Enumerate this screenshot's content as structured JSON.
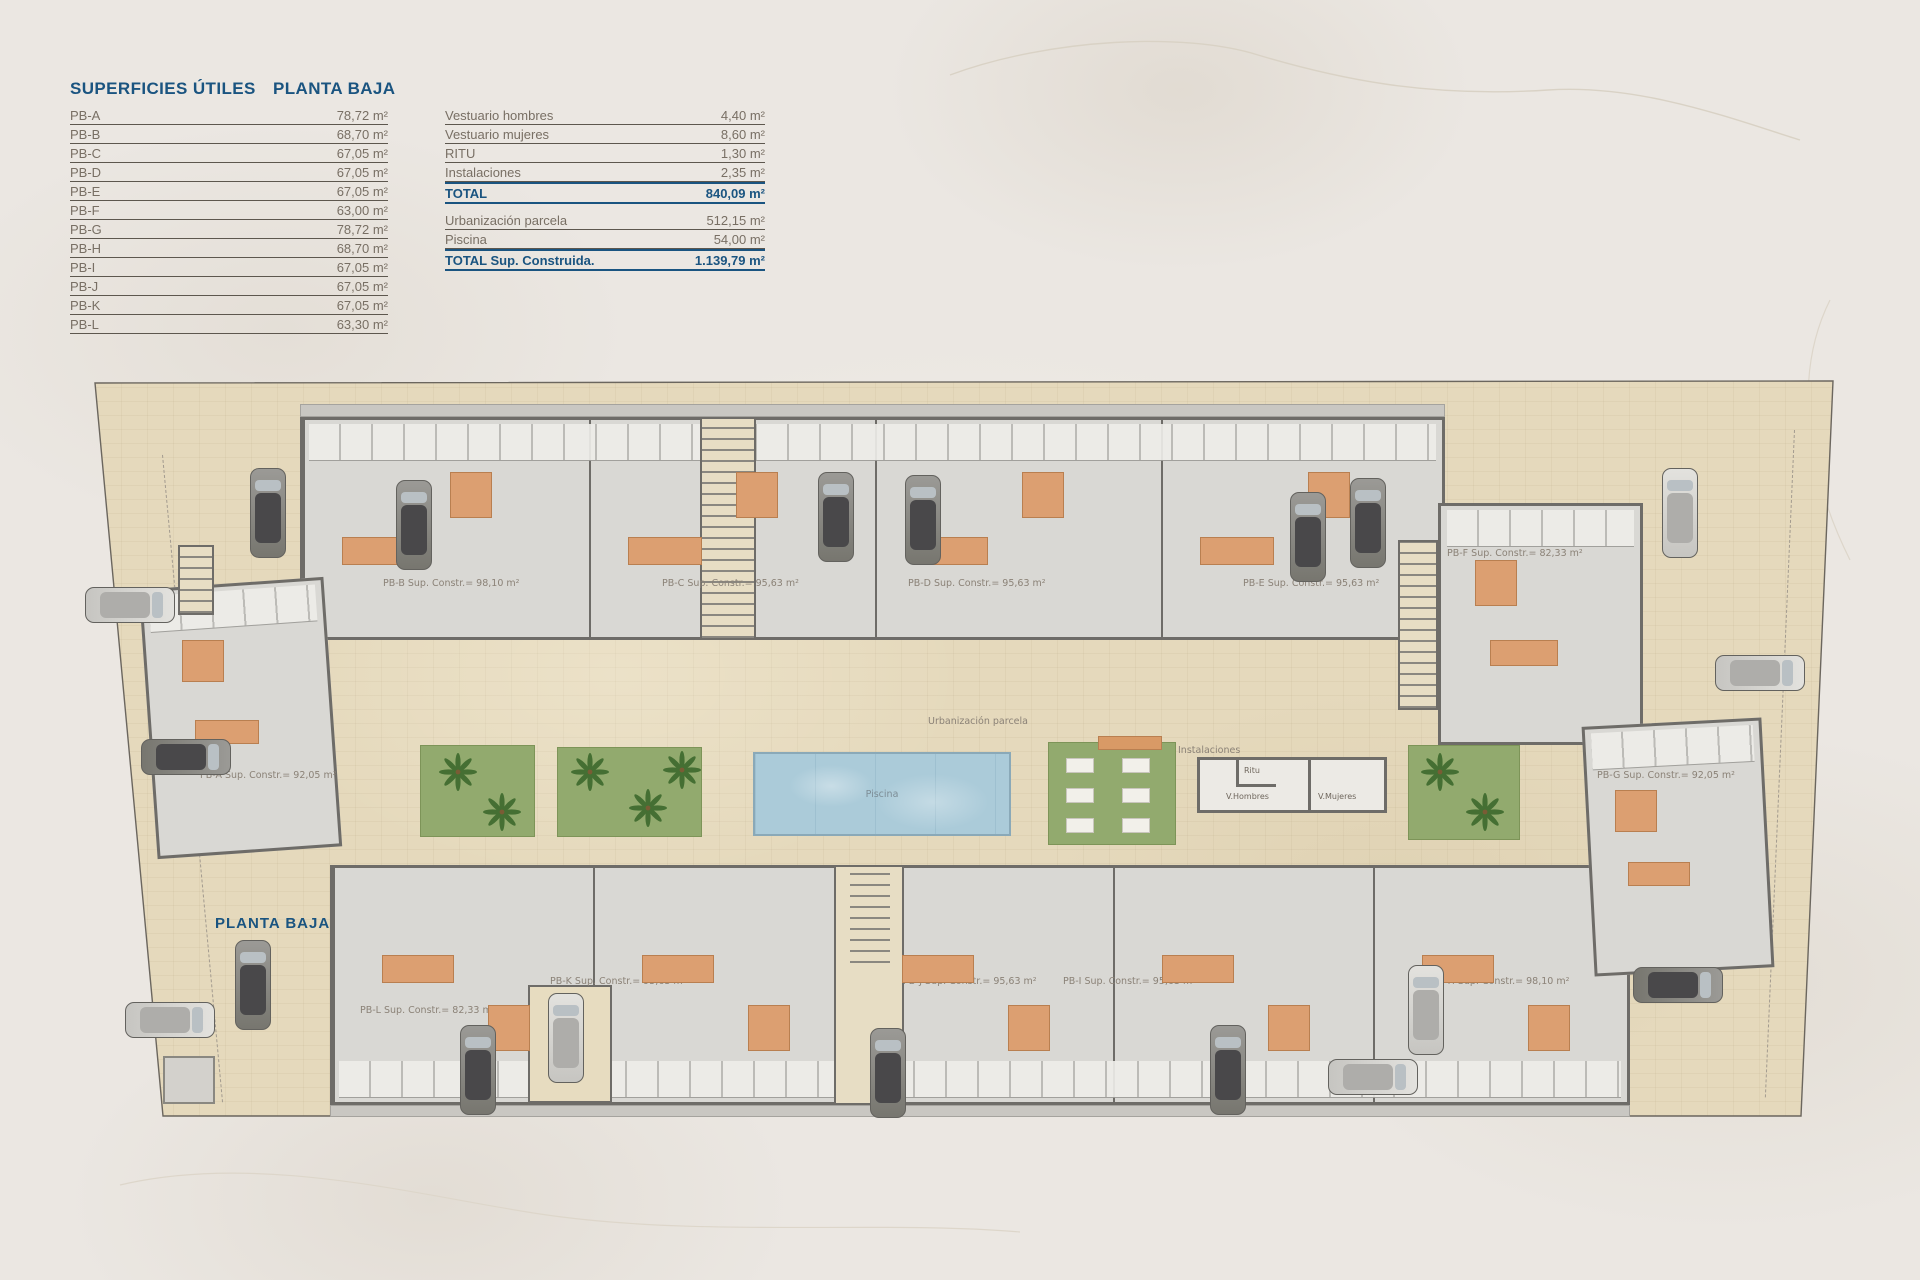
{
  "header": {
    "surfaces_title": "SUPERFICIES ÚTILES",
    "floor_title": "PLANTA BAJA"
  },
  "footer": {
    "floor_title": "PLANTA BAJA"
  },
  "surfaces_table": {
    "rows": [
      {
        "label": "PB-A",
        "value": "78,72 m²"
      },
      {
        "label": "PB-B",
        "value": "68,70 m²"
      },
      {
        "label": "PB-C",
        "value": "67,05 m²"
      },
      {
        "label": "PB-D",
        "value": "67,05 m²"
      },
      {
        "label": "PB-E",
        "value": "67,05 m²"
      },
      {
        "label": "PB-F",
        "value": "63,00 m²"
      },
      {
        "label": "PB-G",
        "value": "78,72 m²"
      },
      {
        "label": "PB-H",
        "value": "68,70 m²"
      },
      {
        "label": "PB-I",
        "value": "67,05 m²"
      },
      {
        "label": "PB-J",
        "value": "67,05 m²"
      },
      {
        "label": "PB-K",
        "value": "67,05 m²"
      },
      {
        "label": "PB-L",
        "value": "63,30 m²"
      }
    ]
  },
  "common_table": {
    "rows": [
      {
        "label": "Vestuario hombres",
        "value": "4,40 m²"
      },
      {
        "label": "Vestuario mujeres",
        "value": "8,60 m²"
      },
      {
        "label": "RITU",
        "value": "1,30 m²"
      },
      {
        "label": "Instalaciones",
        "value": "2,35 m²"
      }
    ],
    "total": {
      "label": "TOTAL",
      "value": "840,09 m²"
    }
  },
  "built_table": {
    "rows": [
      {
        "label": "Urbanización parcela",
        "value": "512,15 m²"
      },
      {
        "label": "Piscina",
        "value": "54,00 m²"
      }
    ],
    "total": {
      "label": "TOTAL Sup. Construida.",
      "value": "1.139,79 m²"
    }
  },
  "plan": {
    "unit_labels": {
      "pb_a": "PB-A Sup. Constr.= 92,05 m²",
      "pb_b": "PB-B Sup. Constr.= 98,10 m²",
      "pb_c": "PB-C Sup. Constr.= 95,63 m²",
      "pb_d": "PB-D Sup. Constr.= 95,63 m²",
      "pb_e": "PB-E Sup. Constr.= 95,63 m²",
      "pb_f": "PB-F Sup. Constr.= 82,33 m²",
      "pb_g": "PB-G Sup. Constr.= 92,05 m²",
      "pb_h": "PB-H Sup. Constr.= 98,10 m²",
      "pb_i": "PB-I Sup. Constr.= 95,63 m²",
      "pb_j": "PB-J Sup. Constr.= 95,63 m²",
      "pb_k": "PB-K Sup. Constr.= 95,63 m²",
      "pb_l": "PB-L Sup. Constr.= 82,33 m²"
    },
    "area_labels": {
      "urbanizacion": "Urbanización parcela",
      "piscina": "Piscina",
      "instalaciones": "Instalaciones",
      "ritu": "Ritu",
      "v_hombres": "V.Hombres",
      "v_mujeres": "V.Mujeres"
    }
  },
  "colors": {
    "accent_blue": "#1a5480",
    "text_gray": "#786f64",
    "paving": "#e5d9bc",
    "garden_green": "#92aa6e",
    "pool_blue": "#abcbd9"
  }
}
